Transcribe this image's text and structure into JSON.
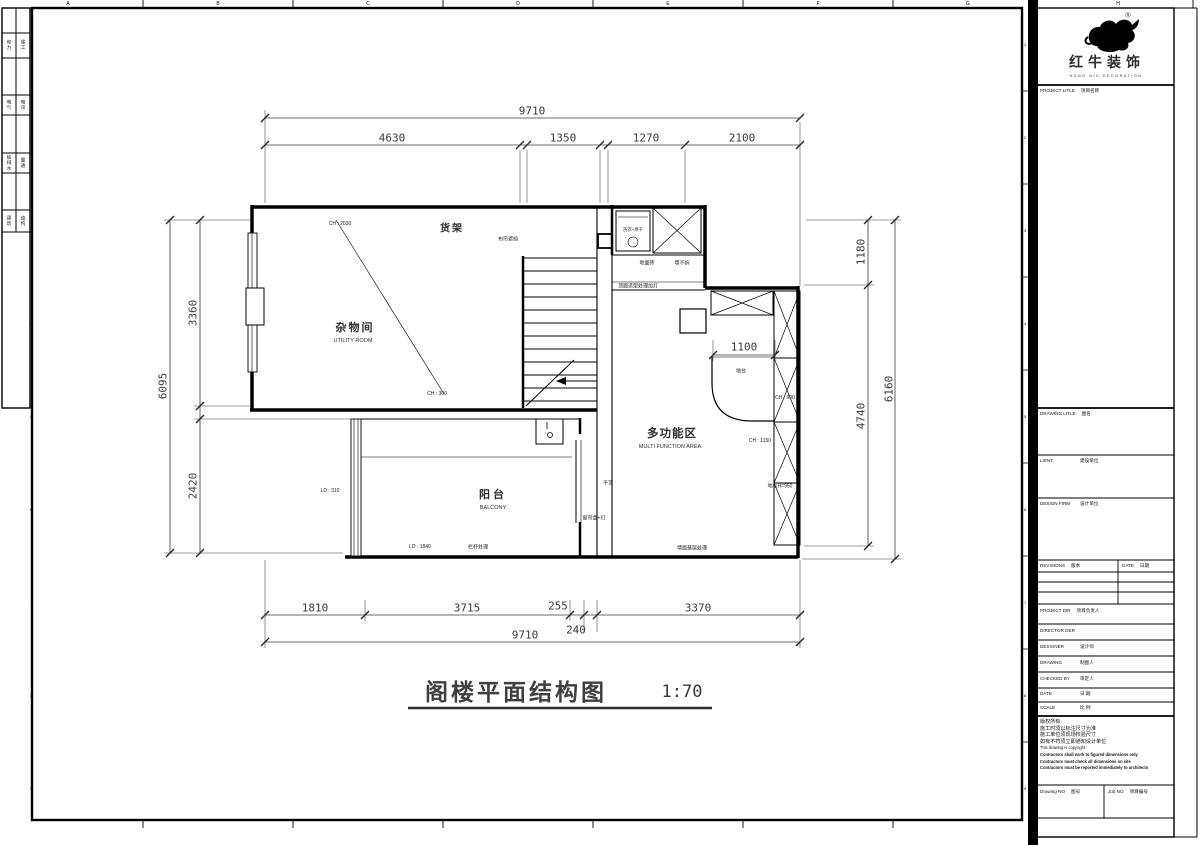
{
  "sheet": {
    "grid_letters": [
      "A",
      "B",
      "C",
      "D",
      "E",
      "F",
      "G",
      "H"
    ],
    "grid_numbers": [
      "1",
      "2",
      "3",
      "4",
      "5",
      "6",
      "7",
      "8",
      "9"
    ],
    "stamps": [
      "动力",
      "竣工",
      "电气",
      "电讯",
      "给排水",
      "暖通",
      "建筑",
      "结构"
    ]
  },
  "title_block": {
    "logo": {
      "cn": "红牛装饰",
      "en": "HONG NIU DECORATION",
      "reg": "®"
    },
    "project_label": "PROJECT LITLE",
    "project_cn": "项目名称",
    "drawing_label": "DRAWING LITLE",
    "drawing_cn": "图名",
    "client_label": "LIENT",
    "client_cn": "建设单位",
    "firm_label": "DESIGN FIRM",
    "firm_cn": "设计单位",
    "revisions_label": "REVISIONS",
    "revisions_cn": "版本",
    "rev_date_label": "DATE",
    "rev_date_cn": "日期",
    "pd_label": "PROJECT DIR",
    "pd_cn": "项目负责人",
    "dir_label": "DIRECTOR DER",
    "dir_cn": "",
    "designer_label": "DESIGNER",
    "designer_cn": "设计师",
    "draw_by_label": "DRAWING",
    "draw_by_cn": "制图人",
    "check_label": "CHECKED BY",
    "check_cn": "审定人",
    "date_label": "DATE",
    "date_cn": "日 期",
    "scale_label": "SCALE",
    "scale_cn": "比 例",
    "notes": [
      "版权所有",
      "施工时须以标注尺寸为准",
      "施工单位须现场校验尺寸",
      "如有不符须立即通知设计单位",
      "This drawing is copyright",
      "Contractors shall work to figured dimensions only",
      "Contractors must check all dimensions on site",
      "Contractors must be reported immediately to architects"
    ],
    "dwg_no_label": "Drawing NO",
    "dwg_no_cn": "图号",
    "job_no_label": "Job NO",
    "job_no_cn": "项目编号"
  },
  "plan": {
    "title": "阁楼平面结构图",
    "scale_text": "1:70",
    "rooms": {
      "utility_cn": "杂物间",
      "utility_en": "UTILITY ROOM",
      "balcony_cn": "阳台",
      "balcony_en": "BALCONY",
      "multi_cn": "多功能区",
      "multi_en": "MULTI FUNCTION AREA"
    },
    "annotations": {
      "shelf": "货架",
      "curtain": "布帘遮挡",
      "washer": "洗衣+烘干",
      "floor_tile": "地面砖",
      "wall_keep": "墙不拆",
      "ceiling": "顶面造型处理加灯",
      "platform": "地台",
      "ch2030": "CH : 2030",
      "ch300": "CH : 300",
      "ch900": "CH : 900",
      "ch1150": "CH : 1150",
      "cabinet": "地柜H=950",
      "flat_ceiling": "平顶",
      "curtain_box": "窗帘盒+灯",
      "ld310": "LD : 310",
      "ld1840": "LD : 1840",
      "railing": "栏杆处理",
      "wall_base": "墙面基层处理"
    },
    "dims": {
      "top_total": "9710",
      "top": [
        "4630",
        "1350",
        "1270",
        "2100"
      ],
      "left_total": "6095",
      "left": [
        "3360",
        "2420"
      ],
      "right": [
        "1180",
        "6160",
        "4740"
      ],
      "bottom": [
        "1810",
        "3715",
        "255",
        "3370"
      ],
      "bottom_stagger": "240",
      "bottom_total": "9710",
      "inner": "1100"
    }
  }
}
